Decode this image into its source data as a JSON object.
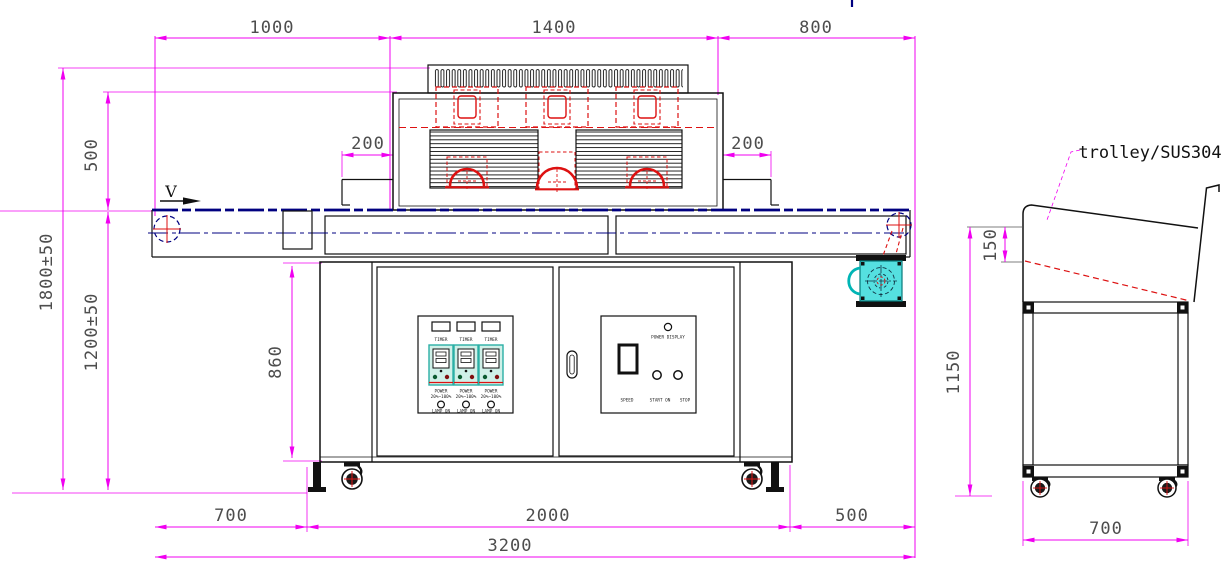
{
  "colors": {
    "dimension_magenta": "#F000F0",
    "drawing_black": "#111111",
    "detail_red": "#DD1111",
    "belt_navy": "#000080",
    "motor_cyan": "#55E0E0",
    "switch_module_teal": "#CFF0E8"
  },
  "front_view": {
    "direction_label": "V",
    "dims": {
      "top_left": "1000",
      "top_middle": "1400",
      "top_right": "800",
      "hood_height": "500",
      "overall_height": "1800±50",
      "belt_height": "1200±50",
      "cabinet_height": "860",
      "entry_overhang": "200",
      "exit_overhang": "200",
      "bottom_left": "700",
      "bottom_middle": "2000",
      "bottom_right": "500",
      "overall_length": "3200"
    },
    "switch_panel": {
      "columns": [
        {
          "timer": "TIMER",
          "power": "POWER",
          "power_range": "20%~100%",
          "lamp": "LAMP ON"
        },
        {
          "timer": "TIMER",
          "power": "POWER",
          "power_range": "20%~100%",
          "lamp": "LAMP ON"
        },
        {
          "timer": "TIMER",
          "power": "POWER",
          "power_range": "20%~100%",
          "lamp": "LAMP ON"
        }
      ]
    },
    "speed_panel": {
      "power_display": "POWER DISPLAY",
      "speed": "SPEED",
      "start": "START ON",
      "stop": "STOP"
    }
  },
  "side_view": {
    "label": "trolley/SUS304",
    "dims": {
      "tray_depth": "150",
      "height": "1150",
      "width": "700"
    }
  }
}
